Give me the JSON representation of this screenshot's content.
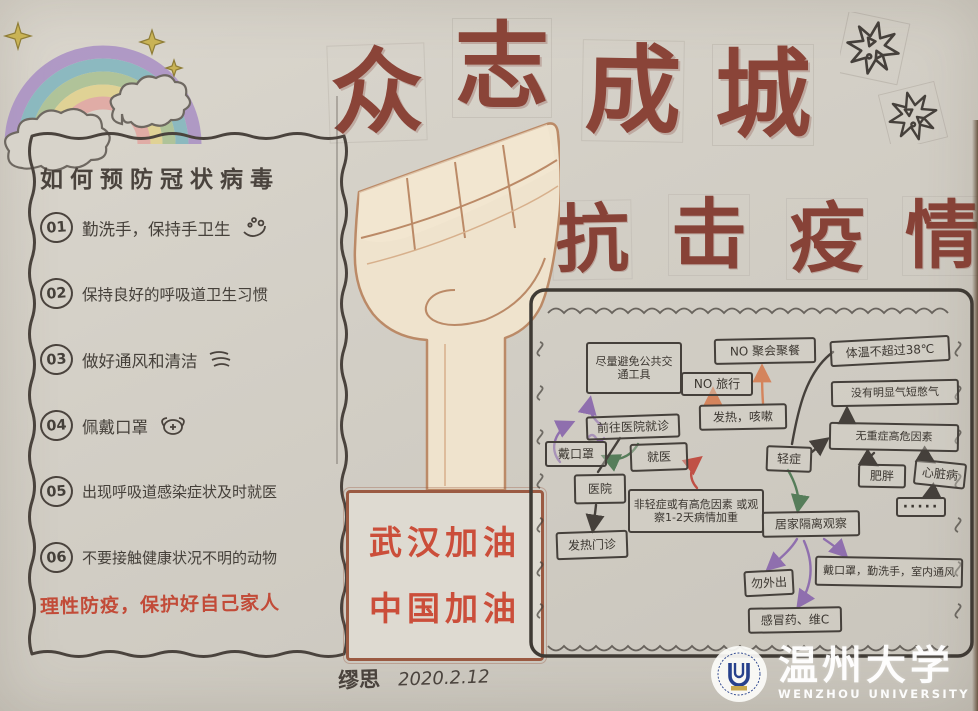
{
  "poster": {
    "title_main": "众志成城",
    "title_sub": "抗击疫情",
    "signature": {
      "author": "缪思",
      "date": "2020.2.12"
    }
  },
  "prevention": {
    "title": "如何预防冠状病毒",
    "items": [
      {
        "num": "01",
        "text": "勤洗手，保持手卫生",
        "icon": "handwash-icon"
      },
      {
        "num": "02",
        "text": "保持良好的呼吸道卫生习惯",
        "icon": ""
      },
      {
        "num": "03",
        "text": "做好通风和清洁",
        "icon": "wind-icon"
      },
      {
        "num": "04",
        "text": "佩戴口罩",
        "icon": "mask-icon"
      },
      {
        "num": "05",
        "text": "出现呼吸道感染症状及时就医",
        "icon": ""
      },
      {
        "num": "06",
        "text": "不要接触健康状况不明的动物",
        "icon": ""
      }
    ],
    "note": "理性防疫，保护好自己家人"
  },
  "cheer": {
    "line1": "武汉加油",
    "line2": "中国加油"
  },
  "flowchart": {
    "nodes": [
      {
        "id": "avoid-public-transport",
        "label": "尽量避免公共交通工具"
      },
      {
        "id": "no-gathering",
        "label": "NO 聚会聚餐"
      },
      {
        "id": "no-travel",
        "label": "NO 旅行"
      },
      {
        "id": "temperature",
        "label": "体温不超过38℃"
      },
      {
        "id": "fever-cough",
        "label": "发热，咳嗽"
      },
      {
        "id": "no-shortness-of-breath",
        "label": "没有明显气短憋气"
      },
      {
        "id": "go-to-hospital",
        "label": "前往医院就诊"
      },
      {
        "id": "wear-mask",
        "label": "戴口罩"
      },
      {
        "id": "seek-medical-care",
        "label": "就医"
      },
      {
        "id": "mild-case",
        "label": "轻症"
      },
      {
        "id": "no-severe-risk-factor",
        "label": "无重症高危因素"
      },
      {
        "id": "hospital",
        "label": "医院"
      },
      {
        "id": "obesity",
        "label": "肥胖"
      },
      {
        "id": "heart-disease",
        "label": "心脏病"
      },
      {
        "id": "ellipsis",
        "label": "·····"
      },
      {
        "id": "not-mild-or-risk",
        "label": "非轻症或有高危因素 或观察1-2天病情加重"
      },
      {
        "id": "home-isolation",
        "label": "居家隔离观察"
      },
      {
        "id": "fever-clinic",
        "label": "发热门诊"
      },
      {
        "id": "no-going-out",
        "label": "勿外出"
      },
      {
        "id": "mask-wash-ventilate",
        "label": "戴口罩，勤洗手，室内通风"
      },
      {
        "id": "cold-medicine",
        "label": "感冒药、维C"
      }
    ]
  },
  "watermark": {
    "name_cn": "温州大学",
    "name_en": "WENZHOU UNIVERSITY"
  },
  "decorations": [
    "rainbow-icon",
    "cloud-icon",
    "sparkle-icon",
    "virus-burst-icon",
    "raised-fist-icon",
    "seal-logo"
  ],
  "colors": {
    "paper": "#d3cfc6",
    "pencil": "#45403b",
    "title_red": "#8a4438",
    "highlight_red": "#c24b38",
    "cheer_red": "#cb4e3a",
    "box_brown": "#9b5a42",
    "purple_arrow": "#8f6fae",
    "green_arrow": "#567d5a",
    "orange_arrow": "#d4845c"
  }
}
